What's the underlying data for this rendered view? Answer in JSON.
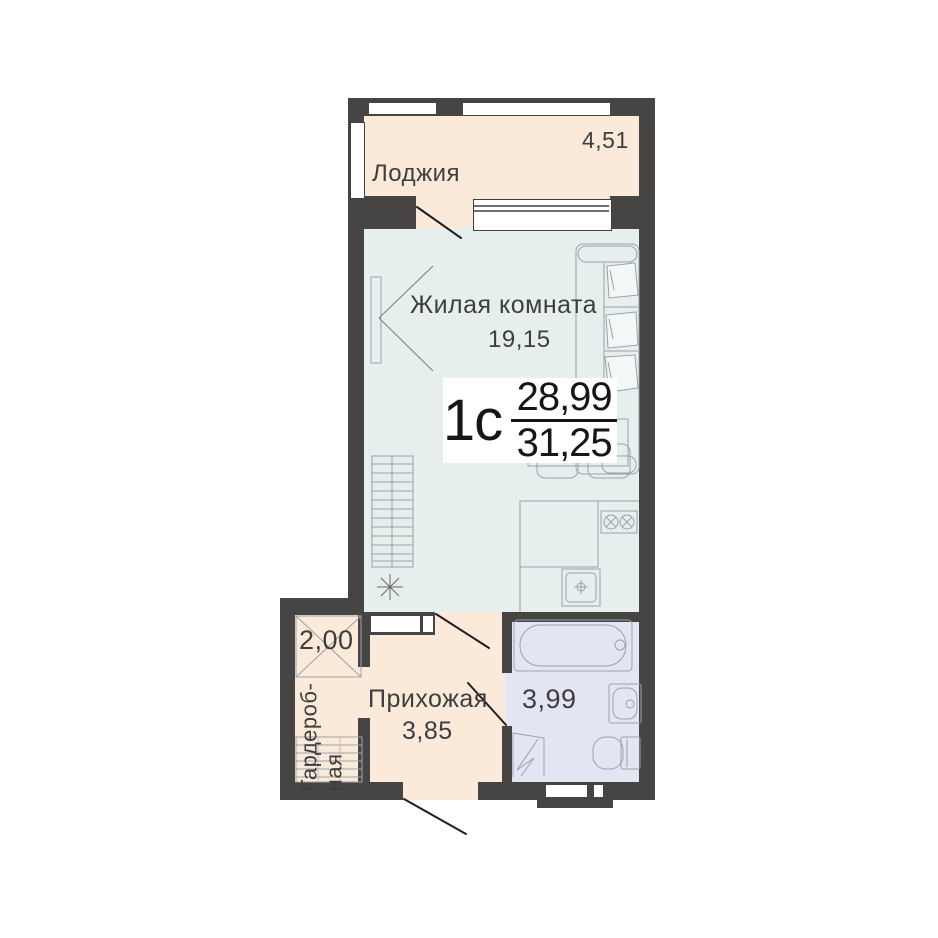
{
  "title_block": {
    "unit_type": "1с",
    "living_area": "28,99",
    "total_area": "31,25"
  },
  "rooms": {
    "loggia": {
      "label": "Лоджия",
      "area": "4,51"
    },
    "living_room": {
      "label": "Жилая комната",
      "area": "19,15"
    },
    "wardrobe": {
      "label_line1": "Гардероб-",
      "label_line2": "ная",
      "area": "2,00"
    },
    "hallway": {
      "label": "Прихожая",
      "area": "3,85"
    },
    "bathroom": {
      "area": "3,99"
    }
  },
  "colors": {
    "wall": "#464543",
    "loggia_fill": "#fbe9da",
    "living_fill": "#e6eeee",
    "bathroom_fill": "#e4e5f3",
    "label_box_bg": "#ffffff",
    "text": "#3e3e3e",
    "furniture_line": "#9aa2a8"
  }
}
